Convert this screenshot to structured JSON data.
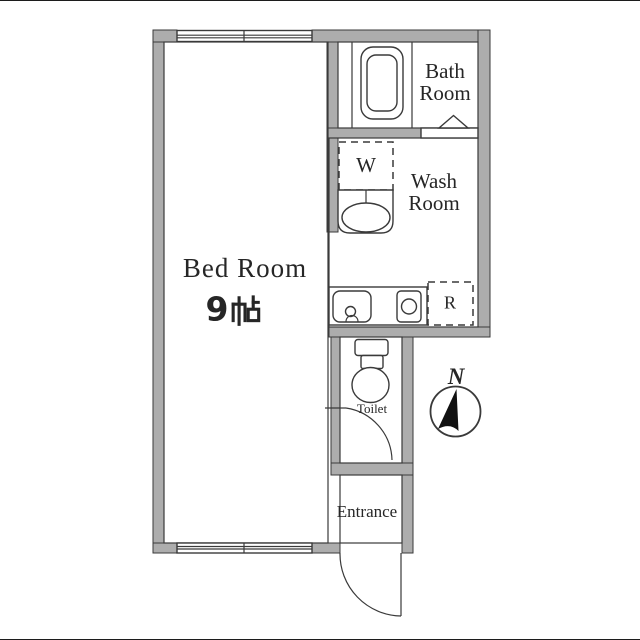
{
  "colors": {
    "wall_fill": "#adadad",
    "line": "#3a3a3a",
    "text": "#262626",
    "needle": "#111111"
  },
  "plan": {
    "bedroom": {
      "name": "Bed Room",
      "size": "9帖",
      "size_number": "9",
      "size_unit": "帖"
    },
    "bathroom": {
      "line1": "Bath",
      "line2": "Room"
    },
    "washroom": {
      "line1": "Wash",
      "line2": "Room"
    },
    "toilet": {
      "name": "Toilet"
    },
    "entrance": {
      "name": "Entrance"
    },
    "washing_machine_label": "W",
    "refrigerator_label": "R",
    "compass_north_label": "N"
  }
}
